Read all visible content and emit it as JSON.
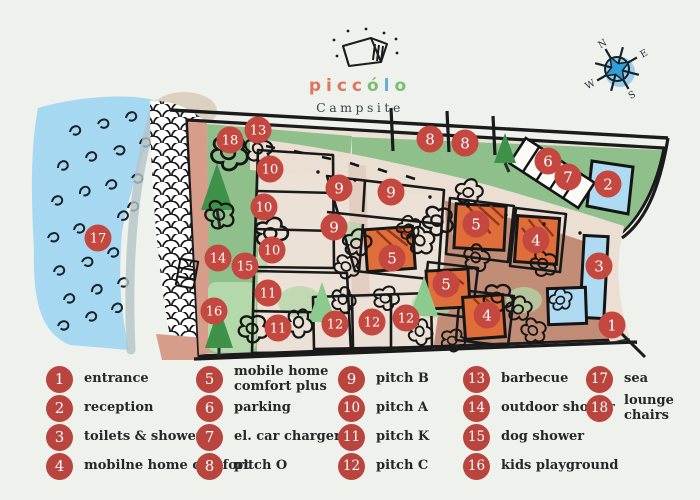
{
  "title": {
    "brand_letters": [
      {
        "ch": "p",
        "color": "#e0755f"
      },
      {
        "ch": "i",
        "color": "#e0755f"
      },
      {
        "ch": "c",
        "color": "#e0755f"
      },
      {
        "ch": "c",
        "color": "#e0755f"
      },
      {
        "ch": "ó",
        "color": "#7cbd72"
      },
      {
        "ch": "l",
        "color": "#69aed6"
      },
      {
        "ch": "o",
        "color": "#7cbd72"
      }
    ],
    "subtitle": "Campsite"
  },
  "compass": {
    "directions": [
      "N",
      "E",
      "S",
      "W"
    ]
  },
  "palette": {
    "legend_red": "#b9453e",
    "marker_red": "#c4483f",
    "water_blue": "#a7d8f2",
    "grass_green": "#8fc08c",
    "terrain_pink": "#c28d76",
    "building_orange": "#e06e3a",
    "building_blue": "#aedbf2",
    "road_cream": "#ebdfd4"
  },
  "map": {
    "markers": [
      {
        "n": 1,
        "x": 612,
        "y": 325
      },
      {
        "n": 2,
        "x": 608,
        "y": 184
      },
      {
        "n": 3,
        "x": 599,
        "y": 266
      },
      {
        "n": 4,
        "x": 536,
        "y": 240
      },
      {
        "n": 4,
        "x": 487,
        "y": 315
      },
      {
        "n": 5,
        "x": 476,
        "y": 224
      },
      {
        "n": 5,
        "x": 392,
        "y": 258
      },
      {
        "n": 5,
        "x": 446,
        "y": 284
      },
      {
        "n": 6,
        "x": 548,
        "y": 161
      },
      {
        "n": 7,
        "x": 568,
        "y": 177
      },
      {
        "n": 8,
        "x": 430,
        "y": 139
      },
      {
        "n": 8,
        "x": 465,
        "y": 143
      },
      {
        "n": 9,
        "x": 339,
        "y": 188
      },
      {
        "n": 9,
        "x": 391,
        "y": 192
      },
      {
        "n": 9,
        "x": 334,
        "y": 227
      },
      {
        "n": 10,
        "x": 270,
        "y": 169
      },
      {
        "n": 10,
        "x": 264,
        "y": 207
      },
      {
        "n": 10,
        "x": 272,
        "y": 250
      },
      {
        "n": 11,
        "x": 268,
        "y": 293
      },
      {
        "n": 11,
        "x": 278,
        "y": 328
      },
      {
        "n": 12,
        "x": 335,
        "y": 324
      },
      {
        "n": 12,
        "x": 372,
        "y": 322
      },
      {
        "n": 12,
        "x": 406,
        "y": 318
      },
      {
        "n": 13,
        "x": 258,
        "y": 130
      },
      {
        "n": 14,
        "x": 218,
        "y": 258
      },
      {
        "n": 15,
        "x": 245,
        "y": 266
      },
      {
        "n": 16,
        "x": 214,
        "y": 311
      },
      {
        "n": 17,
        "x": 98,
        "y": 238
      },
      {
        "n": 18,
        "x": 230,
        "y": 140
      }
    ]
  },
  "legend": {
    "columns": [
      {
        "items": [
          {
            "n": 1,
            "label": "entrance"
          },
          {
            "n": 2,
            "label": "reception"
          },
          {
            "n": 3,
            "label": "toilets & showers"
          },
          {
            "n": 4,
            "label": "mobilne home comfort"
          }
        ]
      },
      {
        "items": [
          {
            "n": 5,
            "label": "mobile home\ncomfort plus"
          },
          {
            "n": 6,
            "label": "parking"
          },
          {
            "n": 7,
            "label": "el. car charger"
          },
          {
            "n": 8,
            "label": "pitch O"
          }
        ]
      },
      {
        "items": [
          {
            "n": 9,
            "label": "pitch B"
          },
          {
            "n": 10,
            "label": "pitch A"
          },
          {
            "n": 11,
            "label": "pitch K"
          },
          {
            "n": 12,
            "label": "pitch C"
          }
        ]
      },
      {
        "items": [
          {
            "n": 13,
            "label": "barbecue"
          },
          {
            "n": 14,
            "label": "outdoor shower"
          },
          {
            "n": 15,
            "label": "dog shower"
          },
          {
            "n": 16,
            "label": "kids playground"
          }
        ]
      },
      {
        "items": [
          {
            "n": 17,
            "label": "sea"
          },
          {
            "n": 18,
            "label": "lounge chairs"
          }
        ]
      }
    ]
  }
}
